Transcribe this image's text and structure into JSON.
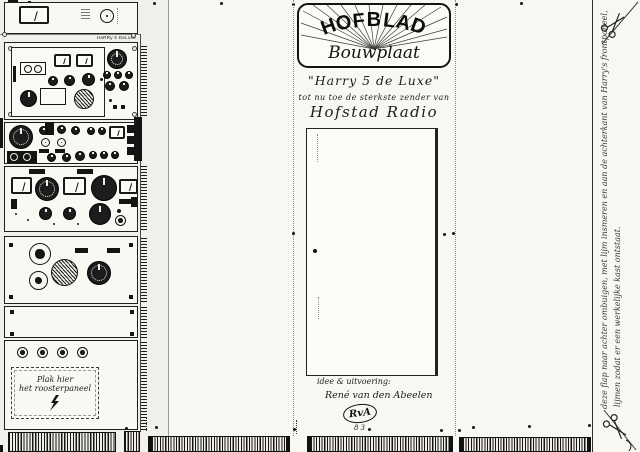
{
  "colors": {
    "paper": "#f8f7f2",
    "ink": "#161616"
  },
  "title_card": {
    "brand": "HOFBLAD",
    "product": "Bouwplaat",
    "model": "\"Harry 5 de Luxe\"",
    "tagline": "tot nu toe de sterkste zender van",
    "station": "Hofstad Radio",
    "credit_label": "idee & uitvoering:",
    "credit_name": "René van den Abeelen",
    "monogram": "RvA",
    "year": "83"
  },
  "left_panels": {
    "model_label": "HaRRy 5 DeLuxe",
    "paste_note": {
      "line1": "Plak hier",
      "line2": "het roosterpaneel"
    }
  },
  "margin_note": {
    "line1": "deze flap naar achter ombuigen, met lijm insmeren en aan de achterkant van Harry's frontpaneel,",
    "line2": "lijmen zodat er een werkelijke kast ontstaat."
  }
}
